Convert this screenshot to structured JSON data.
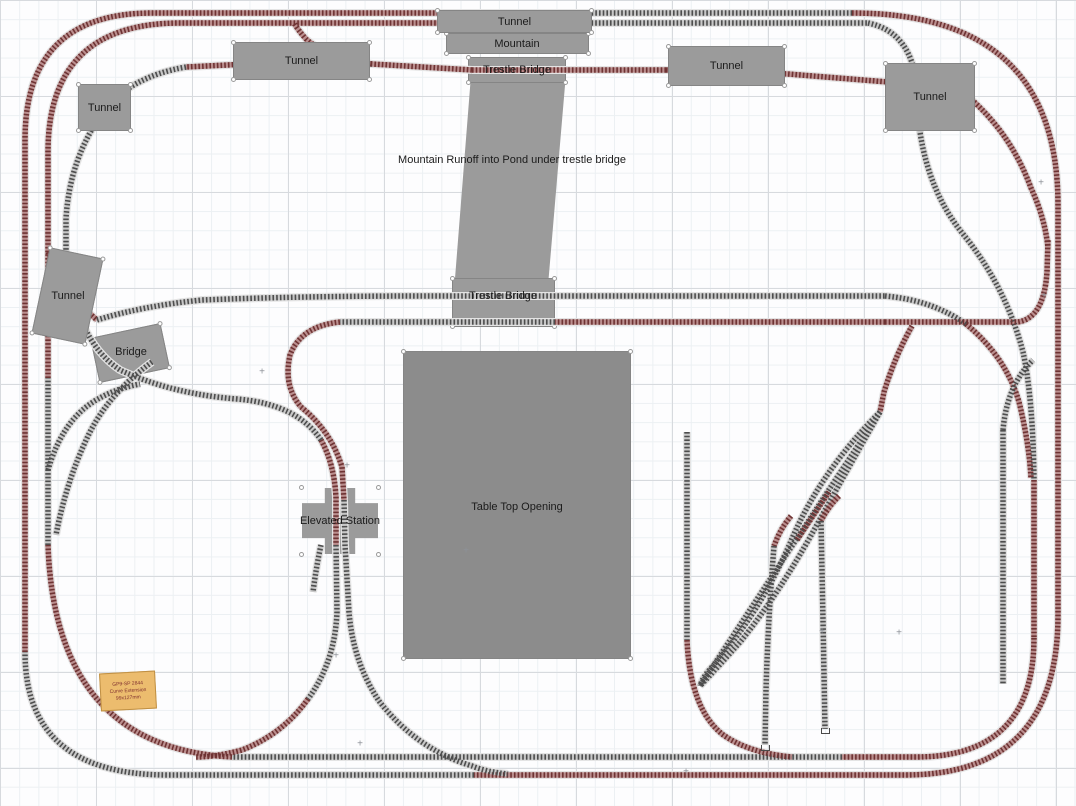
{
  "diagram": {
    "labels": {
      "tunnel": "Tunnel",
      "mountain": "Mountain",
      "trestle_bridge": "Trestle Bridge",
      "bridge": "Bridge",
      "elevated_station": "Elevated Station",
      "table_top_opening": "Table Top Opening",
      "runoff_note": "Mountain Runoff into Pond under trestle bridge"
    },
    "note_tag": {
      "line1": "GP9-SP 2844",
      "line2": "Curve Extension",
      "line3": "99x127mm"
    },
    "colors": {
      "track_red_tie": "#6e3333",
      "track_red_base": "#bb8f8f",
      "track_gray_tie": "#4d4d4d",
      "track_gray_base": "#c8c8c8",
      "structure_gray": "#9b9b9b",
      "opening_gray": "#8c8c8c",
      "note_orange": "#ecbc6e"
    }
  }
}
